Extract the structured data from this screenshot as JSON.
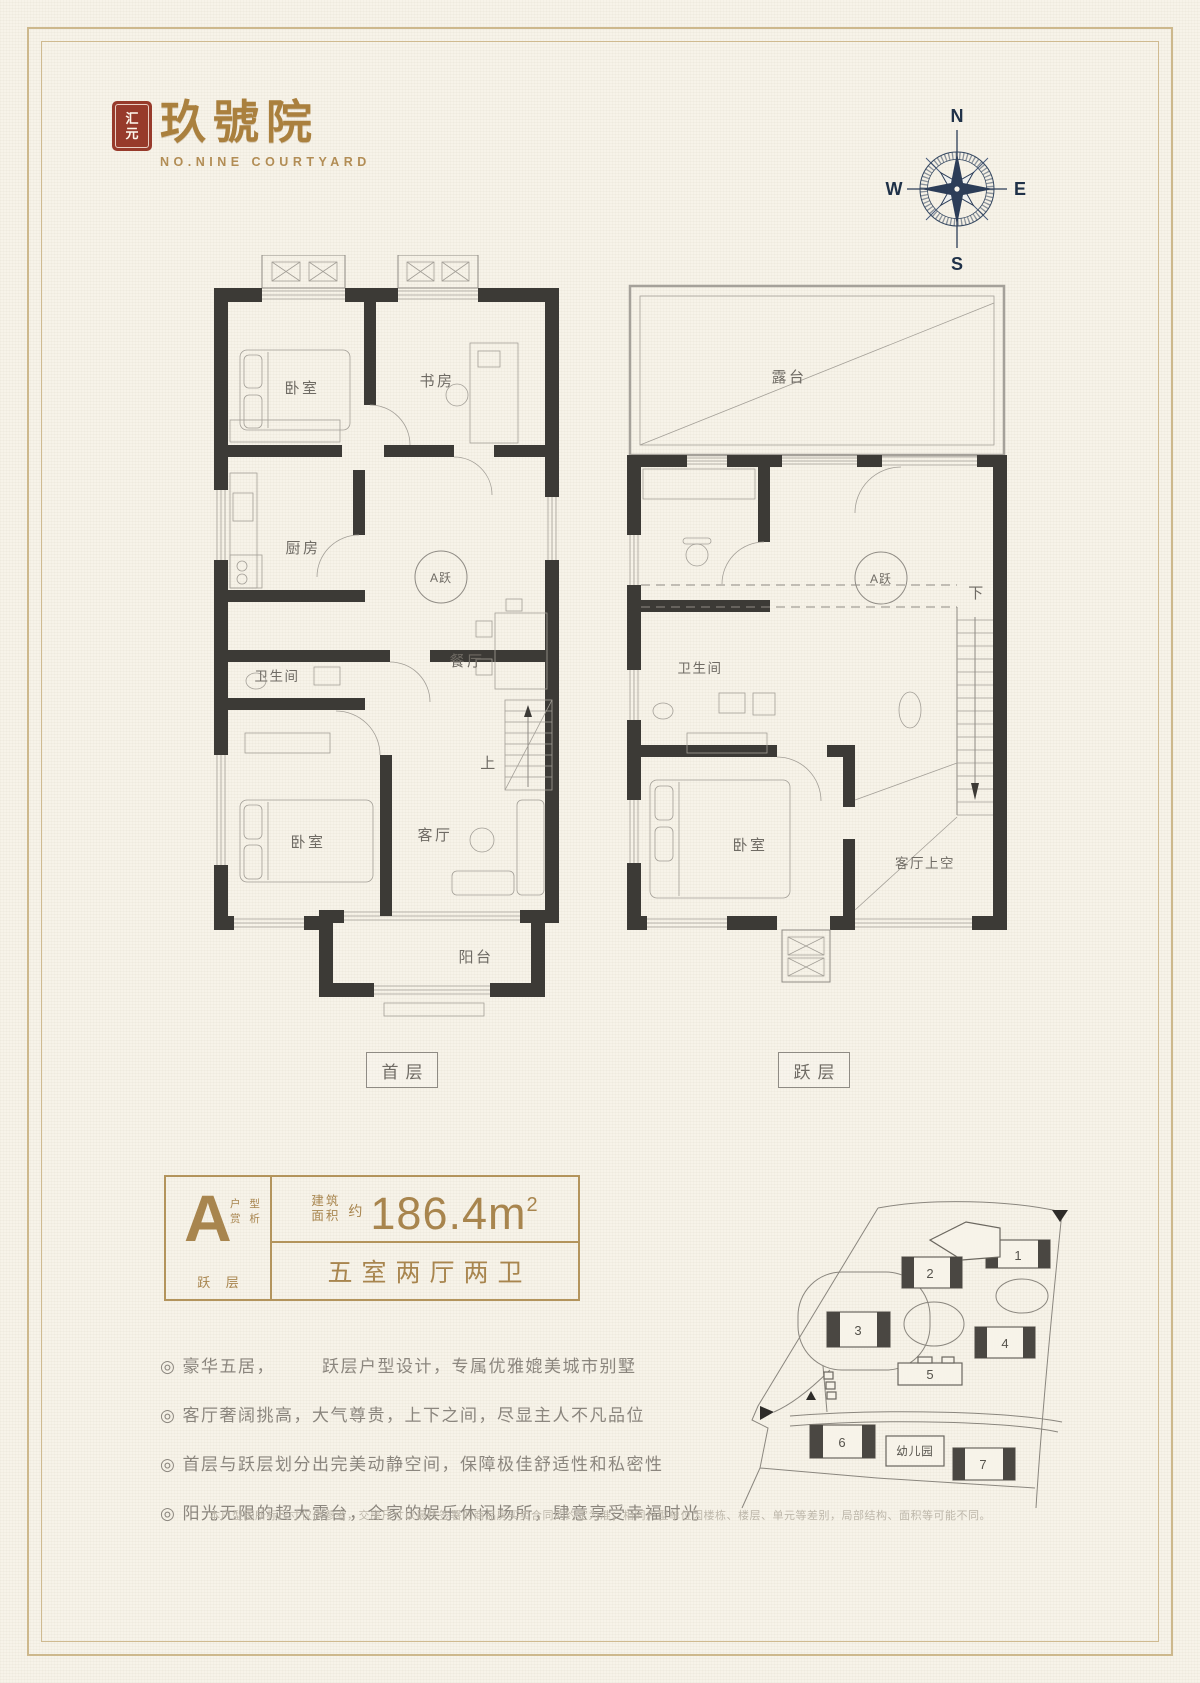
{
  "logo": {
    "seal_top": "汇",
    "seal_bottom": "元",
    "title": "玖號院",
    "subtitle": "NO.NINE COURTYARD"
  },
  "compass": {
    "n": "N",
    "e": "E",
    "s": "S",
    "w": "W"
  },
  "floor1": {
    "tag": "首层",
    "bedroom_top": "卧室",
    "study": "书房",
    "kitchen": "厨房",
    "bath": "卫生间",
    "dining": "餐厅",
    "unit_badge": "A跃",
    "bedroom_bottom": "卧室",
    "living": "客厅",
    "stairs_up": "上",
    "balcony": "阳台"
  },
  "floor2": {
    "tag": "跃层",
    "terrace": "露台",
    "bath": "卫生间",
    "unit_badge": "A跃",
    "stairs_down": "下",
    "bedroom": "卧室",
    "living_void": "客厅上空"
  },
  "unit_info": {
    "type_letter": "A",
    "type_caption_row1": "户 型",
    "type_caption_row2": "赏 析",
    "type_floor": "跃 层",
    "area_label_row1": "建筑",
    "area_label_row2": "面积",
    "approx": "约",
    "area_value": "186.4m",
    "area_exp": "2",
    "layout": "五室两厅两卫"
  },
  "features": [
    "◎ 豪华五居，　　　跃层户型设计，专属优雅媲美城市别墅",
    "◎ 客厅奢阔挑高，大气尊贵，上下之间，尽显主人不凡品位",
    "◎ 首层与跃层划分出完美动静空间，保障极佳舒适性和私密性",
    "◎ 阳光无限的超大露台，全家的娱乐休闲场所，肆意享受幸福时光"
  ],
  "sitemap": {
    "buildings": [
      "1",
      "2",
      "3",
      "4",
      "5",
      "6",
      "7"
    ],
    "kindergarten": "幼儿园"
  },
  "disclaimer": "本户型图所标尺寸仅供参考，交房尺寸以最终签署的商品房买卖合同的约定为准；相同户型单位因楼栋、楼层、单元等差别，局部结构、面积等可能不同。",
  "colors": {
    "accent_gold": "#a8854e",
    "seal_red": "#973a2b",
    "compass_navy": "#2c3d58",
    "wall_dark": "#3c3a36",
    "paper": "#f7f3e9",
    "frame_gold": "#cdb88c"
  }
}
